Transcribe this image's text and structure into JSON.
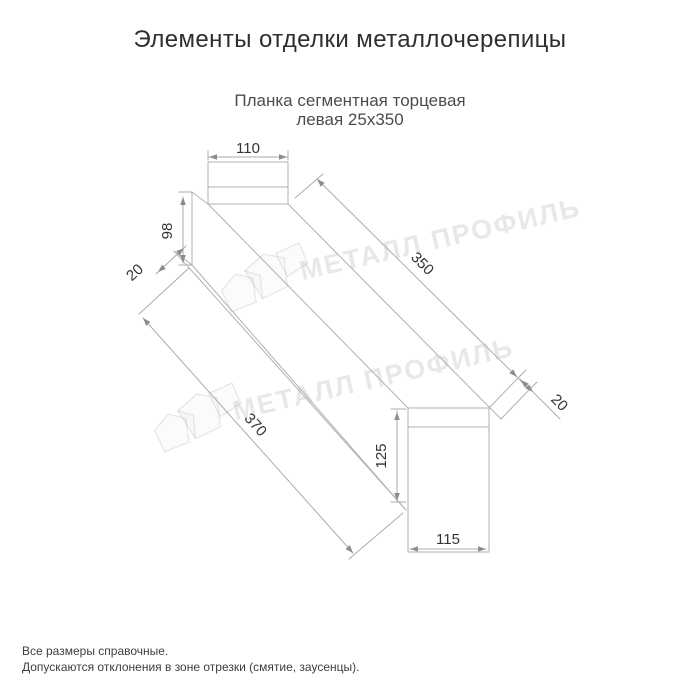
{
  "page": {
    "title": "Элементы отделки металлочерепицы"
  },
  "product": {
    "subtitle_line1": "Планка сегментная торцевая",
    "subtitle_line2": "левая 25х350"
  },
  "dimensions": {
    "top_width": "110",
    "left_height": "98",
    "left_fold": "20",
    "length_top": "350",
    "right_fold": "20",
    "length_bottom": "370",
    "right_height": "125",
    "bottom_width": "115"
  },
  "watermark": {
    "text": "МЕТАЛЛ ПРОФИЛЬ"
  },
  "footer": {
    "note1": "Все размеры справочные.",
    "note2": "Допускаются отклонения в зоне отрезки (смятие, заусенцы)."
  },
  "colors": {
    "title_text": "#2e2e2e",
    "subtitle_text": "#4c4c4c",
    "drawing_line": "#b3b0ac",
    "dimension_text": "#333333"
  }
}
